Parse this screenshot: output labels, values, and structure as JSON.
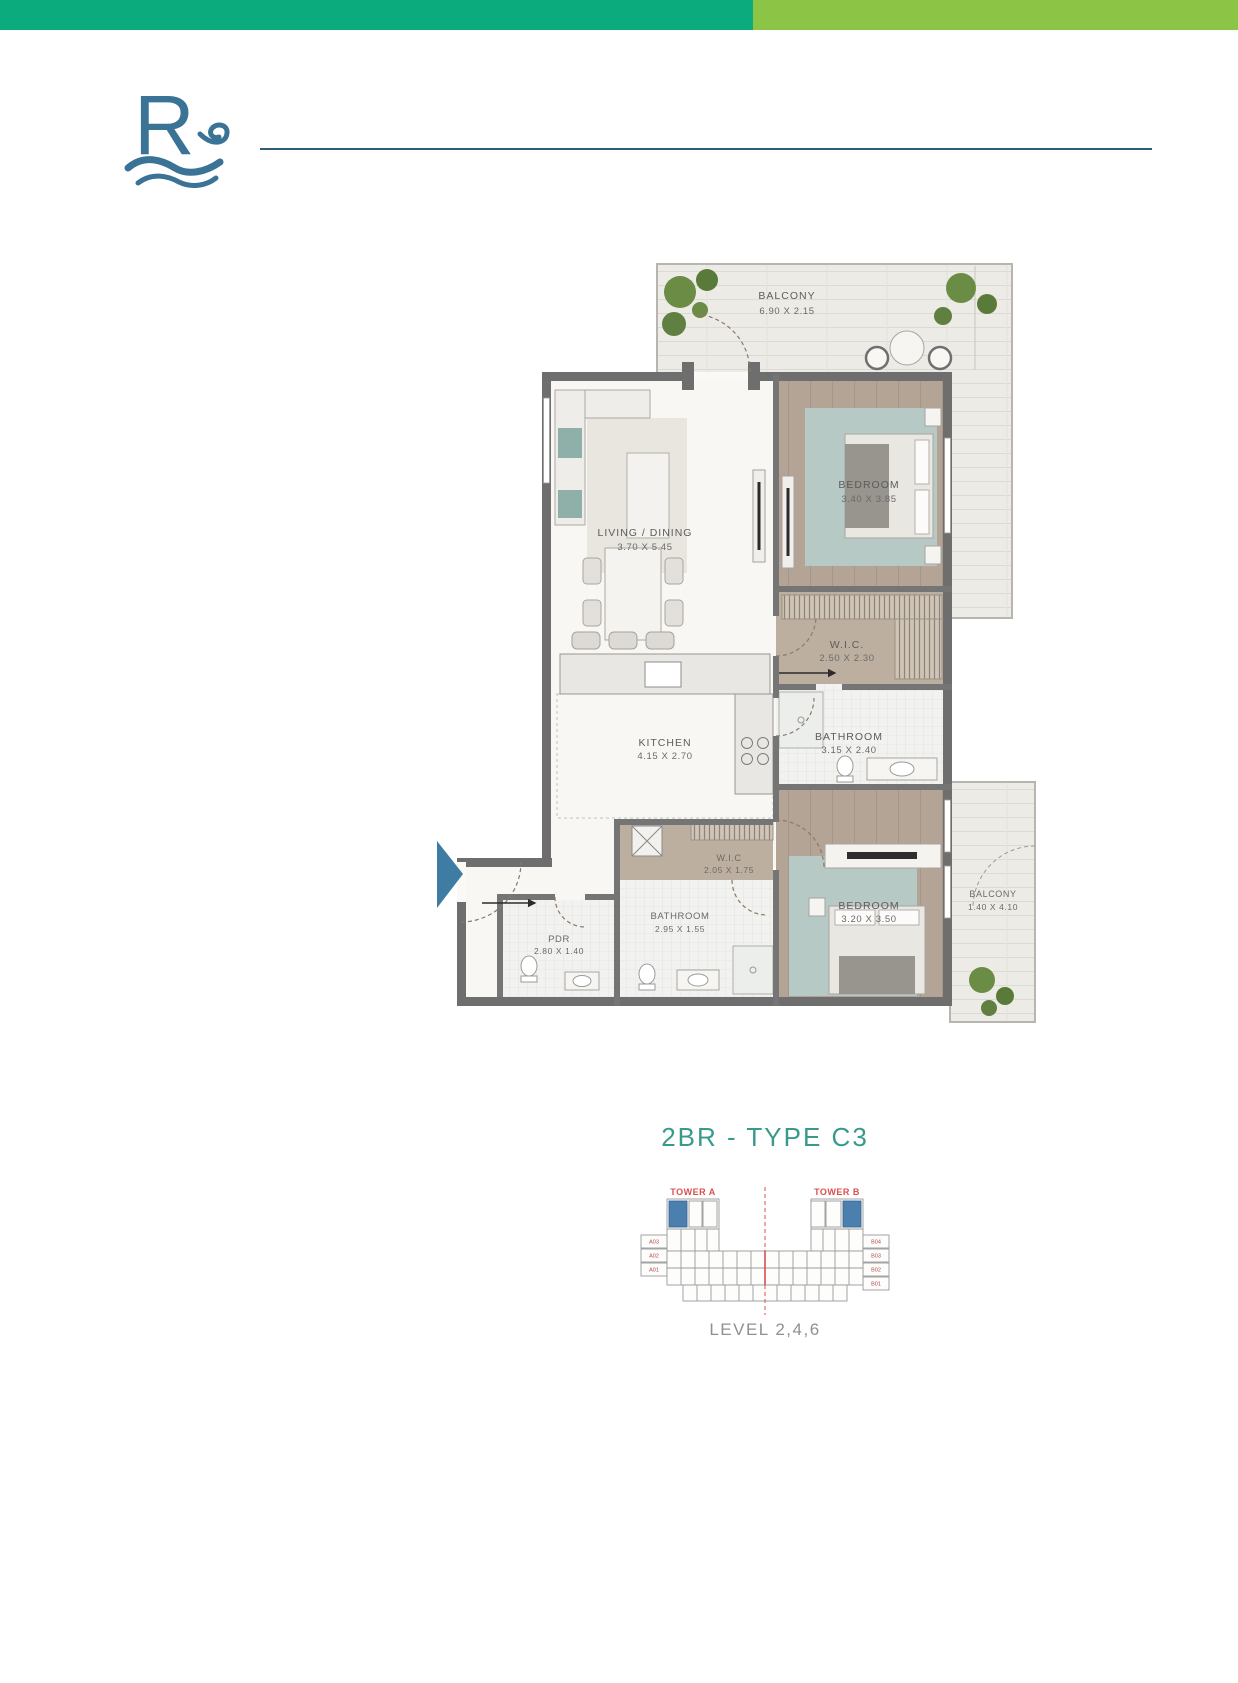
{
  "page": {
    "background_color": "#ffffff"
  },
  "top_bar": {
    "left_color": "#0bab7e",
    "right_color": "#8cc546"
  },
  "brand": {
    "logo_letter": "R",
    "logo_color": "#3a7396"
  },
  "floor_plan": {
    "entry_arrow_color": "#3e7ca3",
    "wall_color": "#6e6e6e",
    "wood_floor_color": "#b3a496",
    "rug_color": "#b7c9c5",
    "plant_color": "#6b8c44",
    "rooms": [
      {
        "id": "balcony-top",
        "name": "BALCONY",
        "dims": "6.90 X 2.15"
      },
      {
        "id": "living-dining",
        "name": "LIVING / DINING",
        "dims": "3.70 X 5.45"
      },
      {
        "id": "bedroom-1",
        "name": "BEDROOM",
        "dims": "3.40 X 3.85"
      },
      {
        "id": "wic-1",
        "name": "W.I.C.",
        "dims": "2.50 X 2.30"
      },
      {
        "id": "bathroom-1",
        "name": "BATHROOM",
        "dims": "3.15 X 2.40"
      },
      {
        "id": "kitchen",
        "name": "KITCHEN",
        "dims": "4.15 X 2.70"
      },
      {
        "id": "wic-2",
        "name": "W.I.C",
        "dims": "2.05 X 1.75"
      },
      {
        "id": "bathroom-2",
        "name": "BATHROOM",
        "dims": "2.95 X 1.55"
      },
      {
        "id": "pdr",
        "name": "PDR",
        "dims": "2.80 X 1.40"
      },
      {
        "id": "bedroom-2",
        "name": "BEDROOM",
        "dims": "3.20 X 3.50"
      },
      {
        "id": "balcony-right",
        "name": "BALCONY",
        "dims": "1.40 X 4.10"
      }
    ]
  },
  "title": {
    "text": "2BR - TYPE C3",
    "color": "#39998b"
  },
  "keyplan": {
    "tower_a_label": "TOWER A",
    "tower_b_label": "TOWER B",
    "level_label": "LEVEL 2,4,6",
    "highlight_color": "#4b7fae",
    "accent_color": "#d94f4f",
    "left_units": [
      "A03",
      "A02",
      "A01"
    ],
    "right_units": [
      "B04",
      "B03",
      "B02",
      "B01"
    ]
  }
}
